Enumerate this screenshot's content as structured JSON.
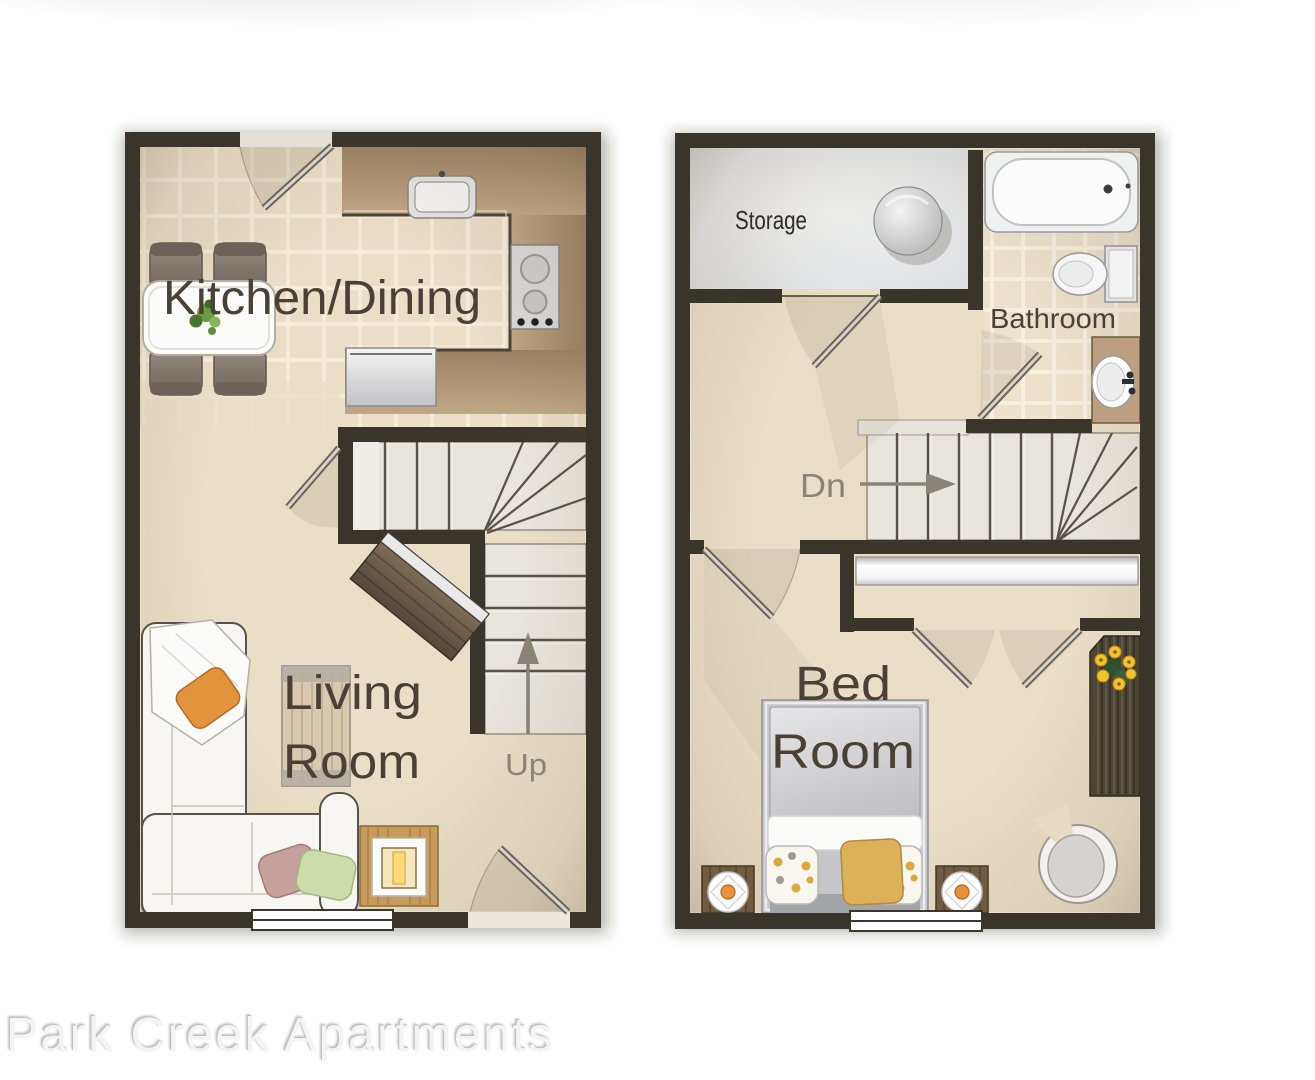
{
  "watermark": "Park Creek Apartments",
  "floor1": {
    "title": "First floor plan",
    "labels": {
      "kitchen_dining": "Kitchen/Dining",
      "living_line1": "Living",
      "living_line2": "Room",
      "stairs": "Up"
    },
    "objects": [
      "dining-table",
      "dining-chairs",
      "kitchen-sink",
      "stove",
      "dishwasher",
      "kitchen-counter",
      "staircase-up",
      "sofa",
      "tv",
      "coffee-table",
      "lamp-table",
      "entry-door",
      "window"
    ]
  },
  "floor2": {
    "title": "Second floor plan",
    "labels": {
      "storage": "Storage",
      "bathroom": "Bathroom",
      "bed_line1": "Bed",
      "bed_line2": "Room",
      "stairs": "Dn"
    },
    "objects": [
      "water-heater",
      "bathtub",
      "toilet",
      "bathroom-sink",
      "staircase-down",
      "closet-sliding-doors",
      "bed",
      "nightstand-lamps",
      "armchair",
      "dresser-with-flowers",
      "window"
    ]
  },
  "colors": {
    "wall": "#39352b",
    "floor_beige": "#e9dec6",
    "tile": "#eadec7",
    "grout": "#f3ecd9",
    "counter_dark": "#9c8264",
    "counter_light": "#c2a787",
    "stair_floor": "#e8e5de",
    "storage_floor": "#e9eaea",
    "label_text": "#4a4136",
    "storage_text": "#2e2c28",
    "stair_text": "#8a8378",
    "accent_orange": "#e0913f",
    "accent_yellow": "#dcb158",
    "watermark_text": "#f4f4f4"
  }
}
